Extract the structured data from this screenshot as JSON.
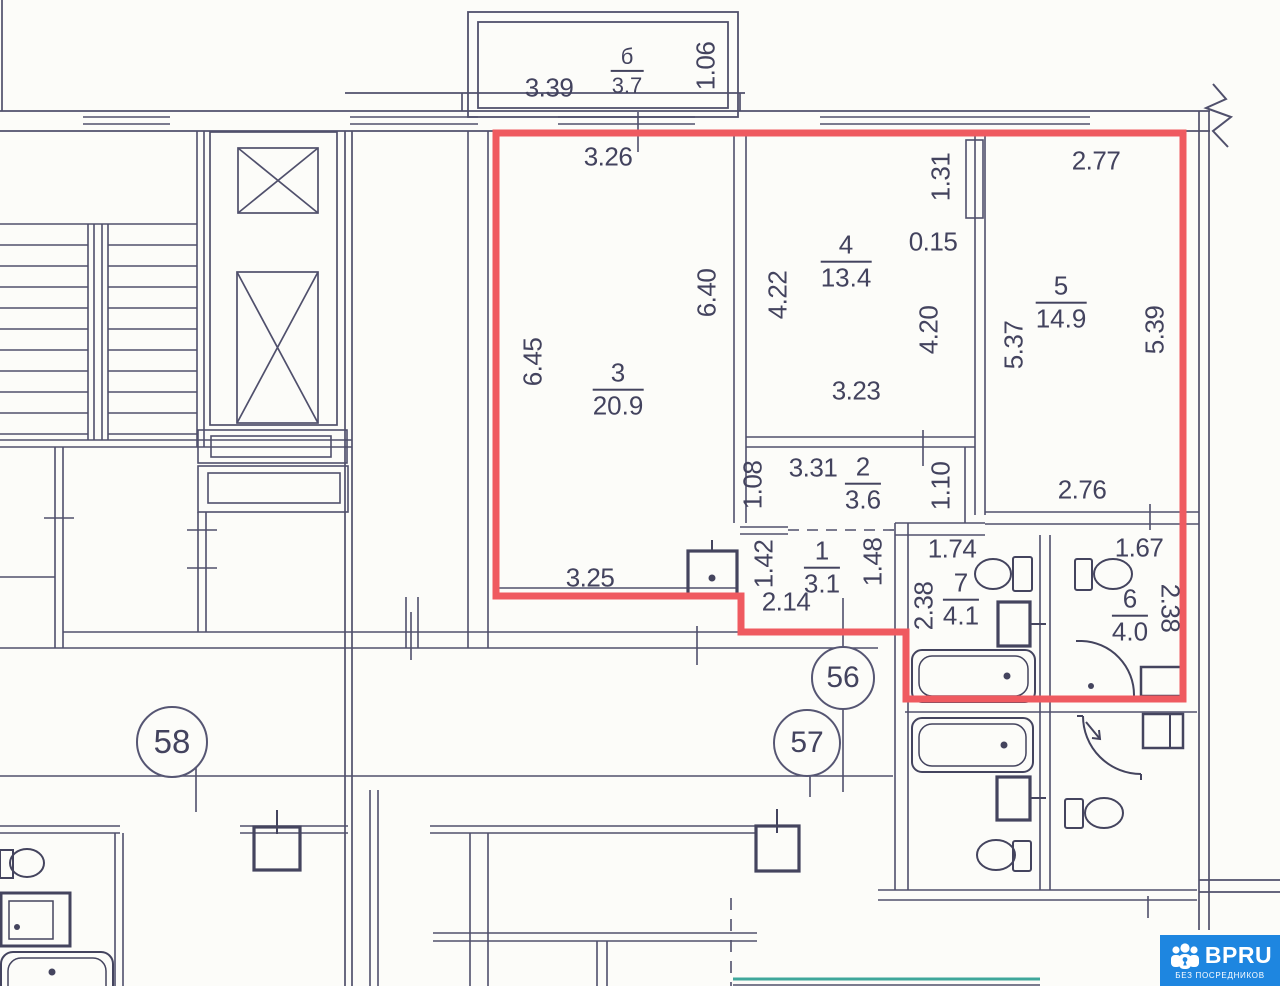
{
  "source_watermark": {
    "brand": "BPRU",
    "tagline": "БЕЗ ПОСРЕДНИКОВ"
  },
  "plan": {
    "unit_circles": [
      "56",
      "57",
      "58"
    ],
    "rooms": [
      {
        "id": "balcony",
        "number": "б",
        "area": "3.7"
      },
      {
        "id": "room-3",
        "number": "3",
        "area": "20.9"
      },
      {
        "id": "room-4",
        "number": "4",
        "area": "13.4"
      },
      {
        "id": "room-5",
        "number": "5",
        "area": "14.9"
      },
      {
        "id": "room-2",
        "number": "2",
        "area": "3.6"
      },
      {
        "id": "room-1",
        "number": "1",
        "area": "3.1"
      },
      {
        "id": "room-7",
        "number": "7",
        "area": "4.1"
      },
      {
        "id": "room-6",
        "number": "6",
        "area": "4.0"
      }
    ],
    "dimensions": {
      "balcony_width": "3.39",
      "balcony_depth": "1.06",
      "room3_top": "3.26",
      "room3_left": "6.45",
      "room3_right": "6.40",
      "room3_bottom": "3.25",
      "room4_left": "4.22",
      "room4_niche": "1.31",
      "room4_wall": "0.15",
      "room4_right": "4.20",
      "room4_bottom": "3.23",
      "room5_top": "2.77",
      "room5_left": "5.37",
      "room5_right": "5.39",
      "room5_bottom": "2.76",
      "room2_top": "3.31",
      "room2_left": "1.08",
      "room2_right": "1.10",
      "room1_left": "1.42",
      "room1_right": "1.48",
      "room1_bottom": "2.14",
      "room7_top": "1.74",
      "room7_left": "2.38",
      "room6_top": "1.67",
      "room6_right": "2.38"
    }
  },
  "colors": {
    "apartment_outline": "#ef5a60",
    "plan_lines": "#50506c",
    "watermark_blue": "#1e86e0",
    "accent_teal": "#3fa79b",
    "text": "#43435e"
  }
}
